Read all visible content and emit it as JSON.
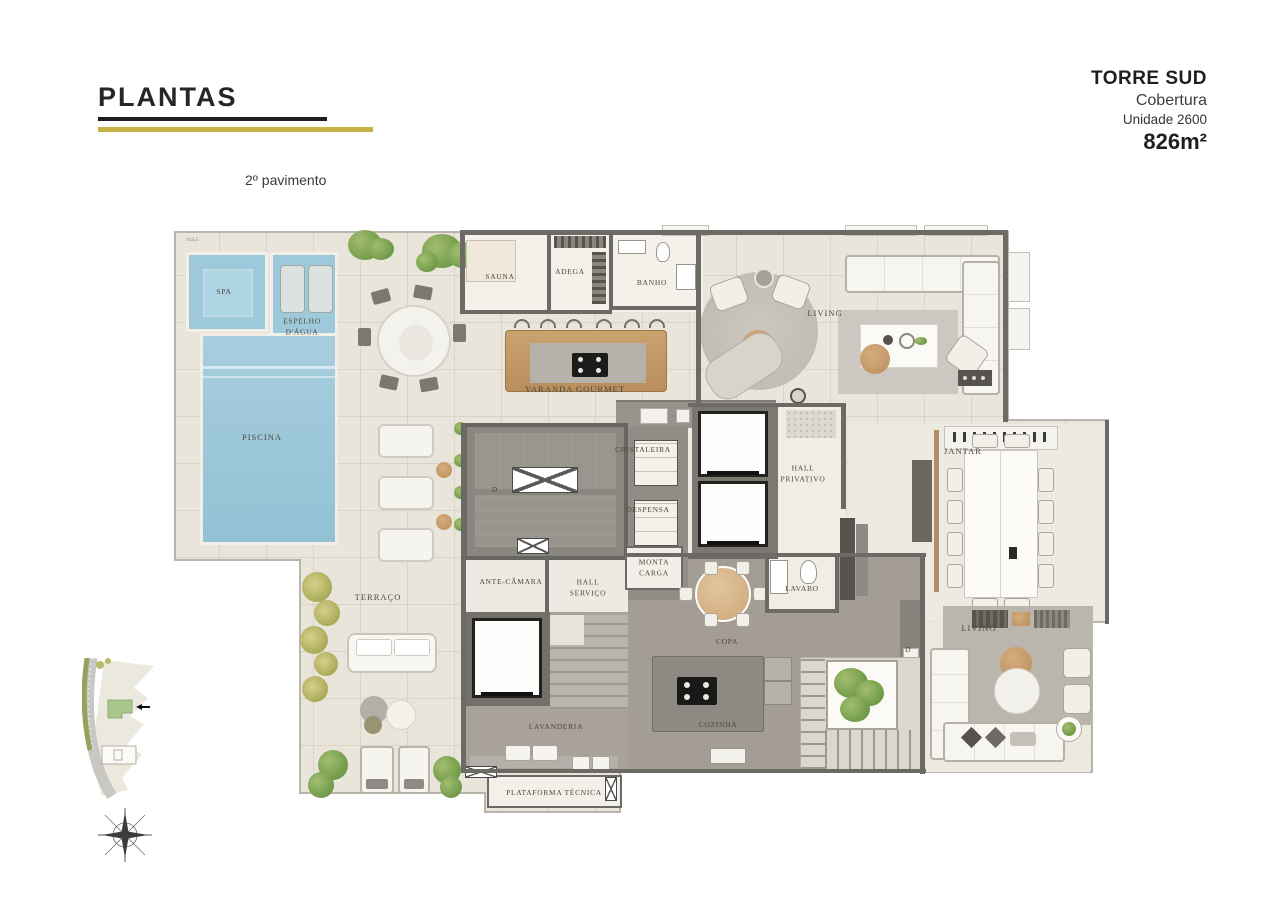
{
  "header": {
    "title": "PLANTAS",
    "floor_label": "2º pavimento"
  },
  "info_block": {
    "tower": "TORRE SUD",
    "subtitle": "Cobertura",
    "unit": "Unidade 2600",
    "area": "826m²"
  },
  "floor_plan": {
    "rooms": {
      "spa": "SPA",
      "espelho_dagua": "ESPELHO\nD'ÁGUA",
      "piscina": "PISCINA",
      "sauna": "SAUNA",
      "adega": "ADEGA",
      "banho": "BANHO",
      "living_superior": "LIVING",
      "varanda_gourmet": "VARANDA GOURMET",
      "cristaleira": "CRISTALEIRA",
      "despensa": "DESPENSA",
      "monta_carga": "MONTA\nCARGA",
      "hall_privativo": "HALL\nPRIVATIVO",
      "lavabo": "LAVABO",
      "jantar": "JANTAR",
      "ante_camara": "ANTE-CÂMARA",
      "hall_servico": "HALL\nSERVIÇO",
      "lavanderia": "LAVANDERIA",
      "copa": "COPA",
      "cozinha": "COZINHA",
      "living_inferior": "LIVING",
      "terraco": "TERRAÇO",
      "plataforma_tecnica": "PLATAFORMA TÉCNICA"
    },
    "door_marker": "D",
    "dimension_top_left": "914,5",
    "colors": {
      "pool_water": "#9ec9db",
      "deck": "#e9e5da",
      "interior_light": "#f3f0e9",
      "service_floor": "#a19b94",
      "wall": "#6b6a65",
      "wood": "#c9a173",
      "accent_gold": "#c8b245"
    }
  }
}
